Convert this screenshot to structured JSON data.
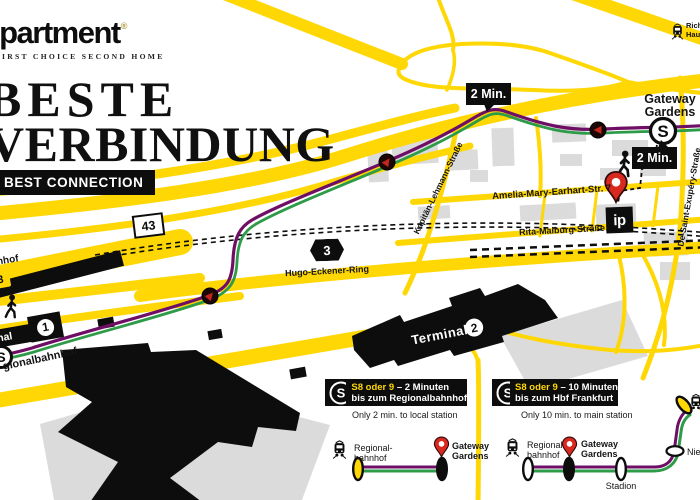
{
  "brand": {
    "name": "ipartment",
    "reg": "®",
    "tagline": "FIRST CHOICE SECOND HOME"
  },
  "title": {
    "line1": "BESTE",
    "line2": "VERBINDUNG",
    "banner": "BEST CONNECTION"
  },
  "map": {
    "badge_43": "43",
    "badge_a3": "3",
    "badge_left": "3",
    "street_hugo": "Hugo-Eckener-Ring",
    "street_kapitaen": "Kapitän-Lehmann-Straße",
    "street_amelia": "Amelia-Mary-Earhart-Str. 7",
    "street_rita": "Rita-Maiburg-Straße",
    "street_exupery": "De-Saint-Exupéry-Straße",
    "label_fernbahnhof": "nhof",
    "label_regionalbahnhof": "gionalbahnhof",
    "terminal1_text": "nal",
    "terminal1_num": "1",
    "terminal2_text": "Terminal",
    "terminal2_num": "2",
    "station_line1": "Gateway",
    "station_line2": "Gardens",
    "sbahn_letter": "S",
    "bubble_top": "2 Min.",
    "bubble_station": "2 Min.",
    "hint_line1": "Rich",
    "hint_line2": "Hau",
    "marker_ip": "ip"
  },
  "infobox1": {
    "sbahn": "S",
    "highlight": "S8 oder 9",
    "rest": " – 2 Minuten",
    "line2": "bis zum Regionalbahnhof",
    "note": "Only 2 min. to local station",
    "stop_from1": "Regional-",
    "stop_from2": "bahnhof",
    "stop_to1": "Gateway",
    "stop_to2": "Gardens"
  },
  "infobox2": {
    "sbahn": "S",
    "highlight": "S8 oder 9",
    "rest": " – 10 Minuten",
    "line2": "bis zum Hbf Frankfurt",
    "note": "Only 10 min. to main station",
    "stop_from1": "Regional-",
    "stop_from2": "bahnhof",
    "stop_mid1": "Gateway",
    "stop_mid2": "Gardens",
    "stop_stadion": "Stadion",
    "stop_nied": "Nied"
  },
  "colors": {
    "road_yellow": "#FFD704",
    "line_purple": "#6E0E64",
    "line_green": "#2E9B48",
    "pin_red": "#D8291F",
    "building_gray": "#DBDBDB",
    "ink_black": "#0d0d0d",
    "reg_gold": "#b39a3f"
  }
}
